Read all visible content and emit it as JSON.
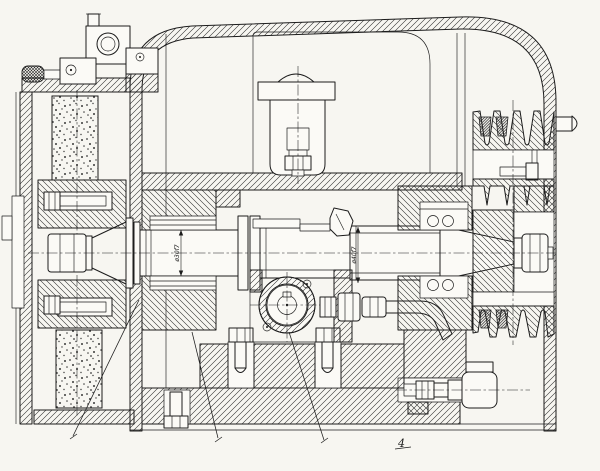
{
  "page": {
    "kind": "engineering-sectional-drawing",
    "paper_color": "#f7f6f1",
    "ink_color": "#1c1c1c"
  },
  "annotations": {
    "dim_left": "ø30f7",
    "dim_center": "ø40f7",
    "ref_numeral": "4"
  }
}
